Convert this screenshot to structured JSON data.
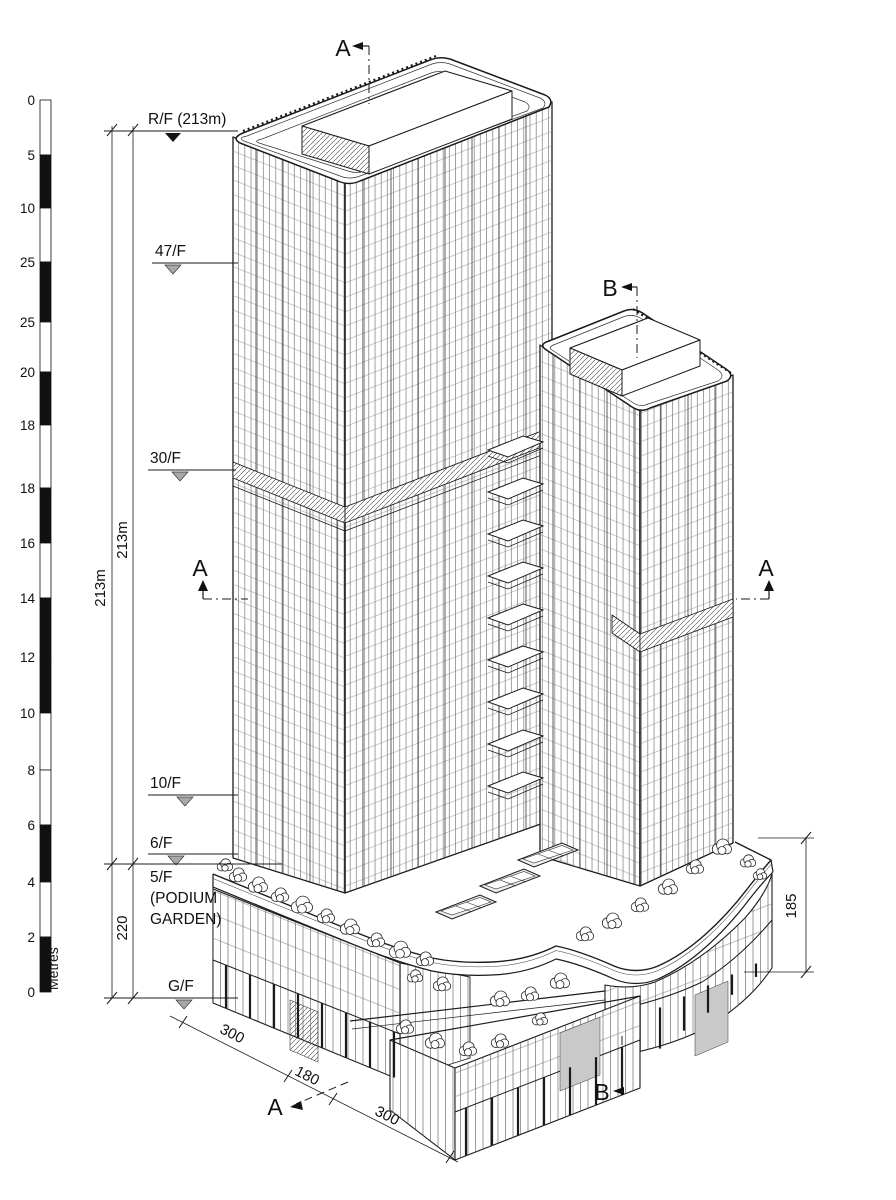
{
  "diagram": {
    "scale_bar": {
      "unit": "Metres",
      "labels": [
        "0",
        "5",
        "10",
        "25",
        "25",
        "20",
        "18",
        "18",
        "16",
        "14",
        "12",
        "10",
        "8",
        "6",
        "4",
        "2",
        "0"
      ]
    },
    "levels": {
      "rf": "R/F (213m)",
      "f47": "47/F",
      "f30": "30/F",
      "f10": "10/F",
      "f6": "6/F",
      "f5": "5/F",
      "f5_note1": "(PODIUM",
      "f5_note2": "GARDEN)",
      "gf": "G/F"
    },
    "dims": {
      "height_a": "213m",
      "height_b": "213m",
      "podium_left": "220",
      "podium_right": "185",
      "plan_300a": "300",
      "plan_180": "180",
      "plan_300b": "300"
    },
    "sections": {
      "a": "A",
      "b": "B"
    }
  },
  "colors": {
    "ink": "#1b1b1b",
    "thin": "#555555",
    "paper": "#ffffff",
    "gray_fill": "#c9c9c9",
    "marker_gray": "#a8a8a8"
  }
}
